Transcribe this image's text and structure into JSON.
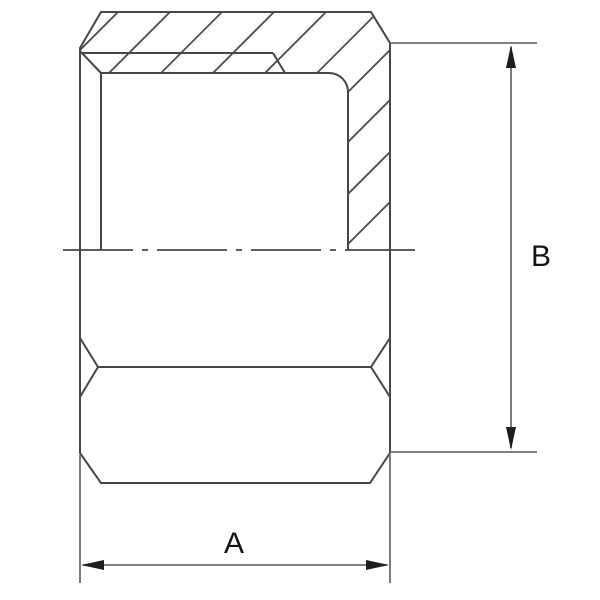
{
  "drawing": {
    "kind": "technical-section-drawing",
    "part": "hex-cap-half-section",
    "dimensions": [
      {
        "label": "A",
        "orientation": "horizontal",
        "position": "bottom"
      },
      {
        "label": "B",
        "orientation": "vertical",
        "position": "right"
      }
    ],
    "colors": {
      "background": "#ffffff",
      "line": "#474747",
      "dim_line": "#6e6e6e",
      "arrow": "#1e1e1e",
      "text": "#141414"
    }
  }
}
